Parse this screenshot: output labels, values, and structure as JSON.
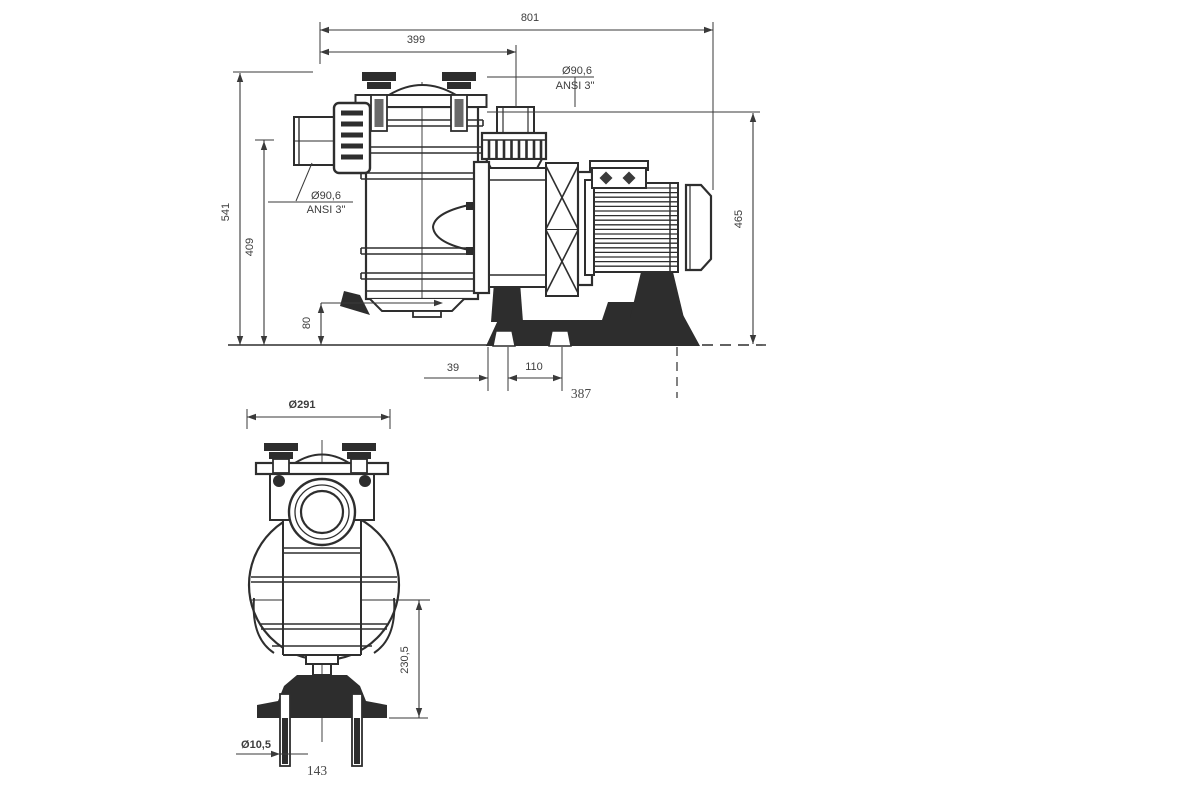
{
  "drawing": {
    "side_view": {
      "dim_overall_length": "801",
      "dim_outlet_center": "399",
      "dim_overall_height": "541",
      "dim_inlet_center_height": "409",
      "dim_drain_height": "80",
      "dim_outlet_top_height": "465",
      "dim_slot_offset": "39",
      "dim_slot_spacing": "110",
      "dim_base_length": "387",
      "outlet_label_diameter": "Ø90,6",
      "outlet_label_standard": "ANSI 3\"",
      "inlet_label_diameter": "Ø90,6",
      "inlet_label_standard": "ANSI 3\""
    },
    "front_view": {
      "dim_lid_diameter": "Ø291",
      "dim_axis_height": "230,5",
      "dim_bolt_hole_diameter": "Ø10,5",
      "dim_bolt_spacing": "143"
    }
  }
}
